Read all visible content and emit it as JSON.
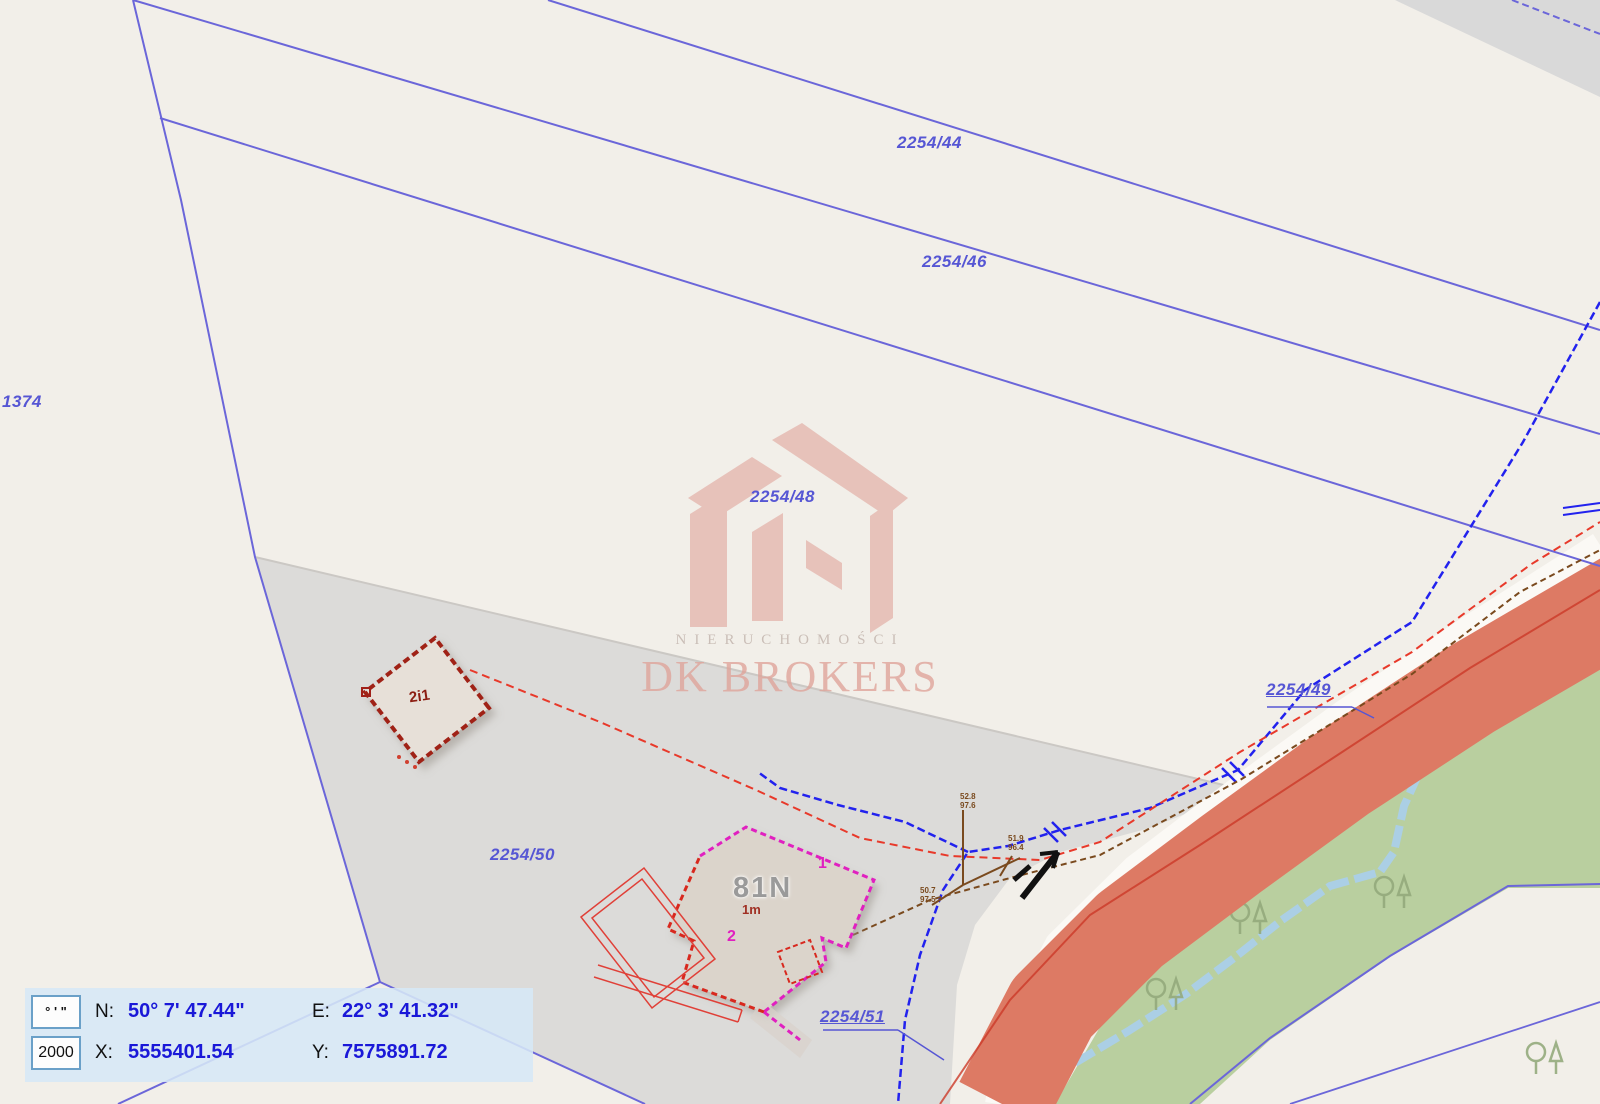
{
  "map": {
    "parcel_labels": [
      {
        "text": "2254/44",
        "x": 897,
        "y": 133,
        "ul": false
      },
      {
        "text": "2254/46",
        "x": 922,
        "y": 252,
        "ul": false
      },
      {
        "text": "2254/48",
        "x": 750,
        "y": 487,
        "ul": false
      },
      {
        "text": "2254/50",
        "x": 490,
        "y": 845,
        "ul": false
      },
      {
        "text": "1374",
        "x": 2,
        "y": 392,
        "ul": false
      },
      {
        "text": "2254/49",
        "x": 1266,
        "y": 680,
        "ul": true
      },
      {
        "text": "2254/51",
        "x": 820,
        "y": 1007,
        "ul": true
      }
    ],
    "building_labels": [
      {
        "text": "81N",
        "x": 733,
        "y": 872,
        "cls": "b81"
      },
      {
        "text": "2i1",
        "x": 409,
        "y": 688,
        "cls": "b2i1"
      },
      {
        "text": "1",
        "x": 818,
        "y": 855,
        "cls": "bmag"
      },
      {
        "text": "2",
        "x": 727,
        "y": 928,
        "cls": "bmag"
      },
      {
        "text": "1m",
        "x": 742,
        "y": 902,
        "cls": "b1m"
      }
    ],
    "utility_annotations": [
      {
        "text": "52.8\n97.6",
        "x": 960,
        "y": 792
      },
      {
        "text": "51.9\n96.4",
        "x": 1008,
        "y": 834
      },
      {
        "text": "50.7\n97.5",
        "x": 920,
        "y": 886
      }
    ],
    "trees": [
      [
        1428,
        694
      ],
      [
        1498,
        688
      ],
      [
        1300,
        806
      ],
      [
        1384,
        886
      ],
      [
        1156,
        988
      ],
      [
        1052,
        1042
      ],
      [
        1536,
        1052
      ],
      [
        1240,
        912
      ]
    ],
    "colors": {
      "background": "#f2efe9",
      "gray_parcel": "#dcdbd9",
      "green_area": "#b9cf9f",
      "road_fill": "#dd7a64",
      "stream": "#abcfe5",
      "parcel_line": "#6b66d9",
      "boundary_blue": "#2222ee",
      "red_line": "#e8392a",
      "utility_brown": "#7a4a1e",
      "building_magenta": "#e020c0",
      "building_dark_red": "#a02018",
      "label_blue": "#5656d4",
      "value_blue": "#1a18d8",
      "panel_bg": "#d6e8f6"
    }
  },
  "watermark": {
    "line1": "NIERUCHOMOŚCI",
    "line2": "DK BROKERS"
  },
  "panel": {
    "dms_symbol": "° ' \"",
    "scale_value": "2000",
    "n_label": "N:",
    "n_value": "50° 7' 47.44\"",
    "e_label": "E:",
    "e_value": "22° 3' 41.32\"",
    "x_label": "X:",
    "x_value": "5555401.54",
    "y_label": "Y:",
    "y_value": "7575891.72"
  }
}
